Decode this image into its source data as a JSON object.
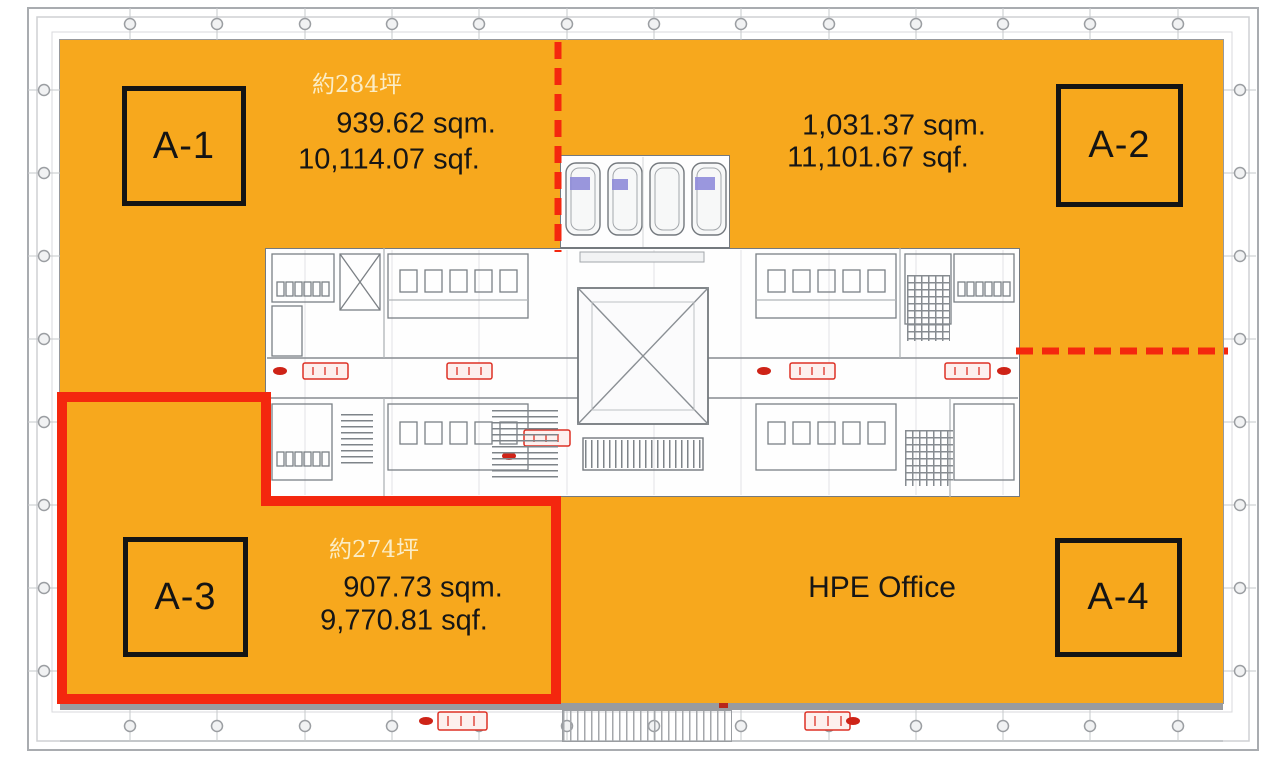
{
  "floor_plan": {
    "zones": [
      {
        "id": "A-1",
        "label": "A-1",
        "tsubo": "約284坪",
        "area_sqm": "939.62 sqm.",
        "area_sqf": "10,114.07 sqf."
      },
      {
        "id": "A-2",
        "label": "A-2",
        "area_sqm": "1,031.37 sqm.",
        "area_sqf": "11,101.67 sqf."
      },
      {
        "id": "A-3",
        "label": "A-3",
        "tsubo": "約274坪",
        "area_sqm": "907.73 sqm.",
        "area_sqf": "9,770.81 sqf."
      },
      {
        "id": "A-4",
        "label": "A-4"
      }
    ],
    "tenant_label": "HPE Office",
    "colors": {
      "zone_fill": "#F7A81D",
      "boundary_red": "#F4270E",
      "tsubo_text": "#FBEDC6",
      "label_text": "#141414",
      "wall_line": "#A9ACB0",
      "plan_line": "#7B8085",
      "elevator_mark": "#8F8CDA",
      "stamp_red": "#DD3125"
    }
  }
}
